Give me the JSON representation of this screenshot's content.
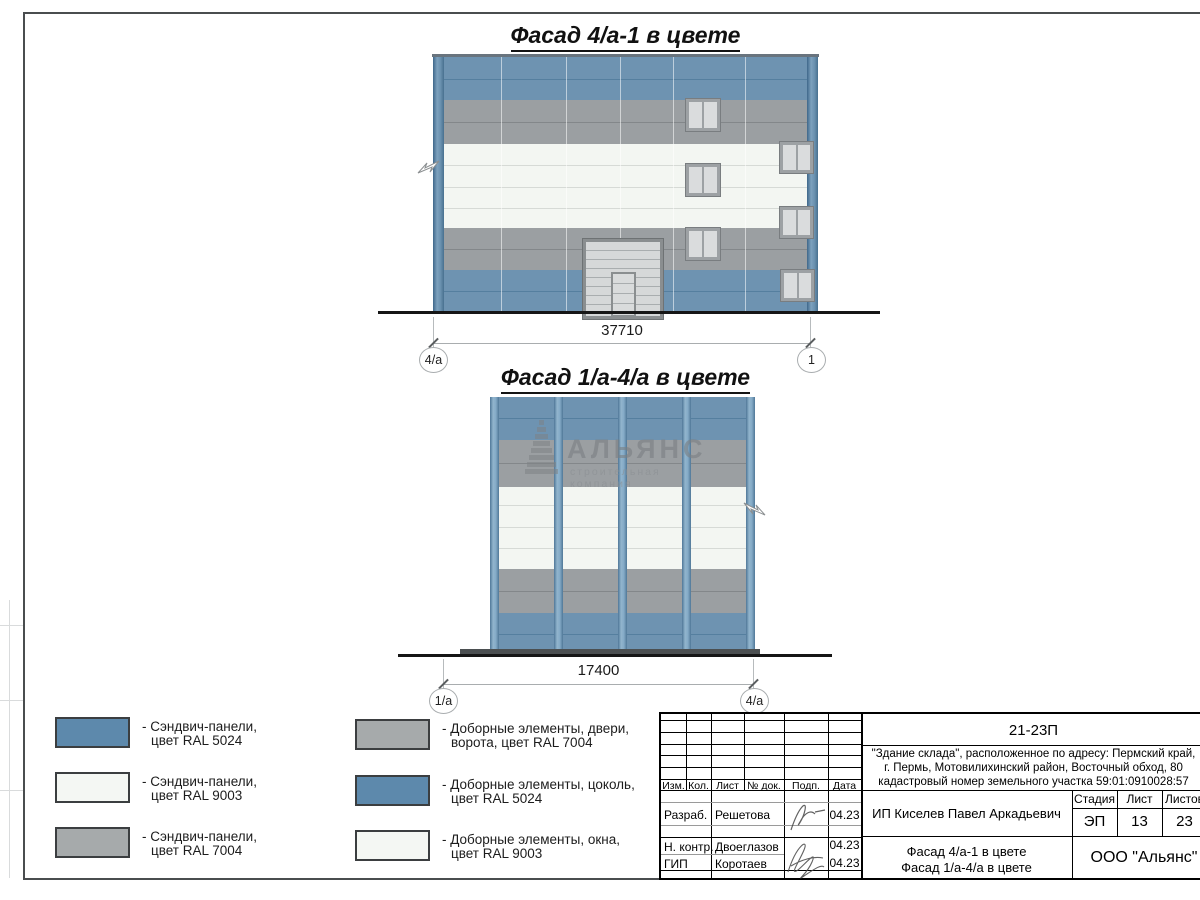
{
  "drawing1": {
    "title": "Фасад 4/а-1 в цвете",
    "dimension": "37710",
    "axis_left": "4/а",
    "axis_right": "1"
  },
  "drawing2": {
    "title": "Фасад 1/а-4/а в цвете",
    "dimension": "17400",
    "axis_left": "1/а",
    "axis_right": "4/а"
  },
  "watermark": {
    "name": "АЛЬЯНС",
    "tagline": "строительная компания"
  },
  "legend": {
    "items": [
      {
        "color": "#5d89ac",
        "line1": "- Сэндвич-панели,",
        "line2": "цвет RAL 5024"
      },
      {
        "color": "#f4f7f3",
        "line1": "- Сэндвич-панели,",
        "line2": "цвет RAL 9003"
      },
      {
        "color": "#a6aaab",
        "line1": "- Сэндвич-панели,",
        "line2": "цвет RAL 7004"
      },
      {
        "color": "#a6aaab",
        "line1": "- Доборные элементы, двери,",
        "line2": "ворота, цвет RAL 7004"
      },
      {
        "color": "#5d89ac",
        "line1": "- Доборные элементы, цоколь,",
        "line2": "цвет RAL 5024"
      },
      {
        "color": "#f4f7f3",
        "line1": "- Доборные элементы, окна,",
        "line2": "цвет RAL 9003"
      }
    ]
  },
  "titleblock": {
    "project_code": "21-23П",
    "address_line1": "\"Здание склада\", расположенное по адресу: Пермский край,",
    "address_line2": "г. Пермь, Мотовилихинский район, Восточный обход, 80",
    "address_line3": "кадастровый номер земельного участка 59:01:0910028:57",
    "columns": {
      "izm": "Изм.",
      "kol": "Кол.",
      "list": "Лист",
      "doc": "№ док.",
      "podp": "Подп.",
      "data": "Дата"
    },
    "rows": [
      {
        "role": "Разраб.",
        "name": "Решетова",
        "date": "04.23"
      },
      {
        "role": "Н. контр.",
        "name": "Двоеглазов",
        "date": "04.23"
      },
      {
        "role": "ГИП",
        "name": "Коротаев",
        "date": "04.23"
      }
    ],
    "customer": "ИП Киселев Павел Аркадьевич",
    "stage_label": "Стадия",
    "sheet_label": "Лист",
    "sheets_label": "Листов",
    "stage": "ЭП",
    "sheet": "13",
    "sheets": "23",
    "doc_title_line1": "Фасад 4/а-1 в цвете",
    "doc_title_line2": "Фасад 1/а-4/а в цвете",
    "company": "ООО \"Альянс\""
  },
  "colors": {
    "panel_blue": "#6e93b1",
    "panel_white": "#f3f6f2",
    "panel_gray": "#9b9fa2",
    "gate_gray": "#d6d8d9",
    "ground": "#161616"
  }
}
